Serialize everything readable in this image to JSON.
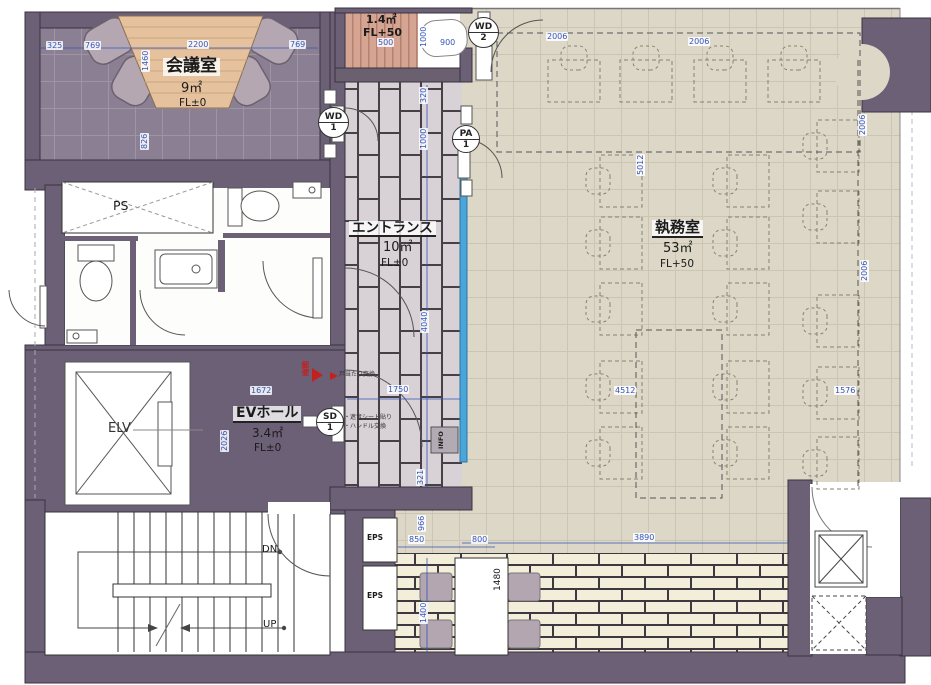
{
  "rooms": {
    "meeting": {
      "name": "会議室",
      "area": "9㎡",
      "level": "FL±0"
    },
    "storage": {
      "area": "1.4㎡",
      "level": "FL+50"
    },
    "entrance": {
      "name": "エントランス",
      "area": "10㎡",
      "level": "FL±0"
    },
    "office": {
      "name": "執務室",
      "area": "53㎡",
      "level": "FL+50"
    },
    "ev_hall": {
      "name": "EVホール",
      "area": "3.4㎡",
      "level": "FL±0"
    },
    "elevator": {
      "label": "ELV"
    },
    "pipe_shaft": {
      "label": "PS"
    },
    "eps1": {
      "label": "EPS"
    },
    "eps2": {
      "label": "EPS"
    },
    "stairs": {
      "down": "DN",
      "up": "UP"
    },
    "info_box": {
      "label": "INFO"
    },
    "mail": {
      "label": "郵便"
    }
  },
  "door_tags": {
    "wd1": {
      "code": "WD",
      "num": "1"
    },
    "wd2": {
      "code": "WD",
      "num": "2"
    },
    "pa1": {
      "code": "PA",
      "num": "1"
    },
    "sd1": {
      "code": "SD",
      "num": "1"
    }
  },
  "notes": {
    "n1": "戸当たり交換",
    "n2": "・遮音シート貼り",
    "n3": "・ハンドル交換"
  },
  "dims": {
    "m325": "325",
    "m769a": "769",
    "m2200": "2200",
    "m769b": "769",
    "m1460": "1460",
    "m826": "826",
    "s500": "500",
    "s1000": "1000",
    "s900": "900",
    "e320": "320",
    "e1000": "1000",
    "e4040": "4040",
    "e1750": "1750",
    "e321": "321",
    "v1672": "1672",
    "v2026": "2026",
    "o2006a": "2006",
    "o2006b": "2006",
    "o2006c": "2006",
    "o2006d": "2006",
    "o5012": "5012",
    "o4512": "4512",
    "o1576": "1576",
    "o3890": "3890",
    "o850": "850",
    "o800": "800",
    "o966": "966",
    "o1400": "1400",
    "o1480": "1480"
  },
  "colors": {
    "wall": "#6b6076",
    "office_floor": "#dcd7c6",
    "carpet": "#8b8093",
    "ev_floor": "#a99ca8",
    "tile": "#d8d1d6",
    "brick": "#f3eeda",
    "deck": "#d6a492",
    "dim_blue": "#3355bb",
    "partition_blue": "#4aa6d8",
    "accent_red": "#c42020",
    "chair": "#b5a7b2",
    "wood": "#e5c29d"
  }
}
